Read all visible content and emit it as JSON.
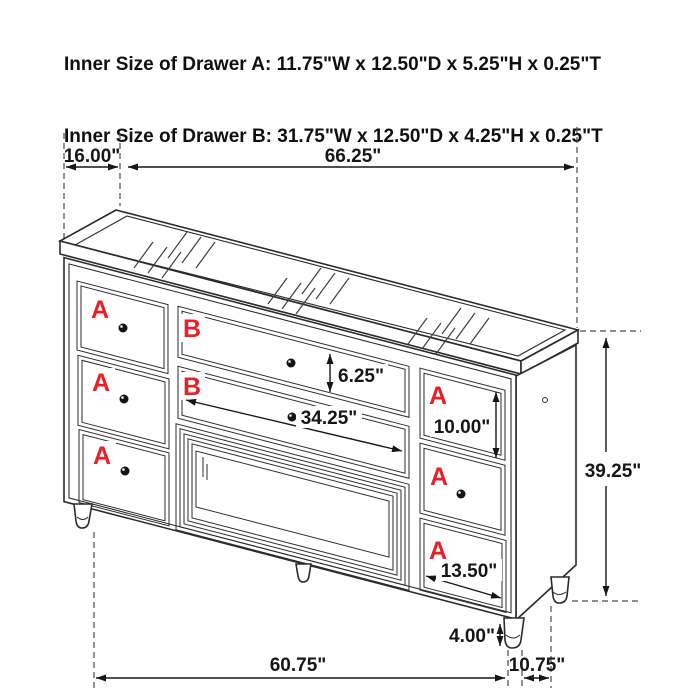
{
  "title": {
    "line1": "Inner Size of Drawer A: 11.75\"W x 12.50\"D x 5.25\"H x 0.25\"T",
    "line2": "Inner Size of Drawer B: 31.75\"W x 12.50\"D x 4.25\"H x 0.25\"T"
  },
  "diagram": {
    "item": "dresser-dimension-drawing",
    "drawer_labels": {
      "a": "A",
      "b": "B"
    },
    "dimensions": {
      "top_depth": "16.00\"",
      "top_width": "66.25\"",
      "drawer_b_face_height": "6.25\"",
      "drawer_b_face_width": "34.25\"",
      "drawer_a_face_height": "10.00\"",
      "drawer_a_face_width": "13.50\"",
      "overall_height": "39.25\"",
      "leg_height": "4.00\"",
      "base_front_width": "60.75\"",
      "base_side_depth": "10.75\""
    },
    "colors": {
      "line": "#2b2b2b",
      "label_red": "#e8202a",
      "background": "#ffffff"
    }
  }
}
